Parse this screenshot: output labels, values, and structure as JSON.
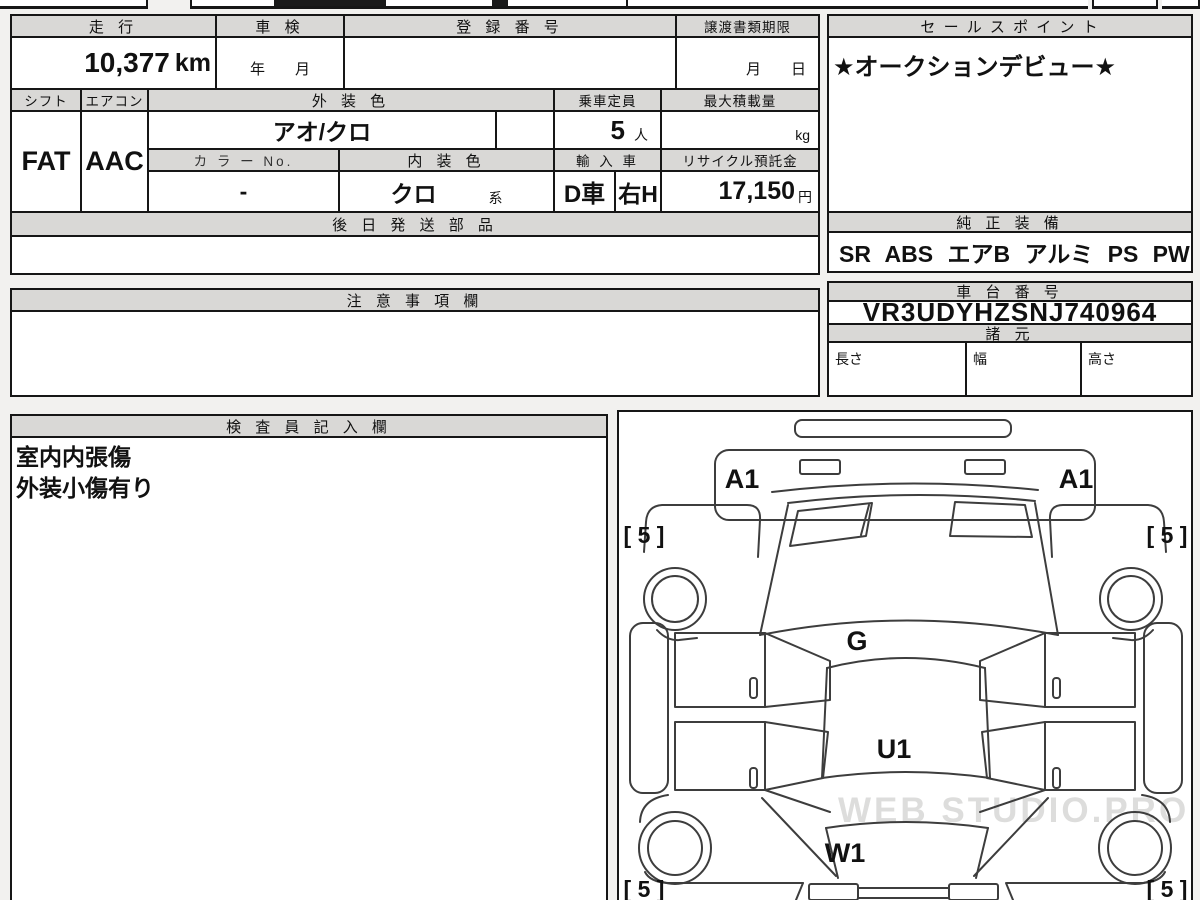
{
  "table": {
    "mileage_label": "走 行",
    "mileage_value": "10,377",
    "mileage_unit": "km",
    "shaken_label": "車 検",
    "shaken_value": "年　　月",
    "reg_label": "登 録 番 号",
    "reg_value": "",
    "transfer_label": "譲渡書類期限",
    "transfer_value": "月　　日",
    "shift_label": "シフト",
    "shift_value": "FAT",
    "aircon_label": "エアコン",
    "aircon_value": "AAC",
    "ext_color_label": "外 装 色",
    "ext_color_value": "アオ/クロ",
    "capacity_label": "乗車定員",
    "capacity_value": "5",
    "capacity_unit": "人",
    "max_load_label": "最大積載量",
    "max_load_unit": "kg",
    "color_no_label": "カ ラ ー No.",
    "color_no_value": "-",
    "int_color_label": "内 装 色",
    "int_color_value": "クロ",
    "int_color_suffix": "系",
    "import_label": "輸 入 車",
    "import_value_1": "D車",
    "import_value_2": "右H",
    "recycle_label": "リサイクル預託金",
    "recycle_value": "17,150",
    "recycle_unit": "円",
    "later_parts_label": "後 日 発 送 部 品",
    "later_parts_value": "",
    "notes_label": "注 意 事 項 欄",
    "notes_value": ""
  },
  "right_panel": {
    "sales_point_label": "セ ー ル ス ポ イ ン ト",
    "sales_point_value": "★オークションデビュー★",
    "equipment_label": "純 正 装 備",
    "equipment_value": "SR ABS エアB アルミ PS PW",
    "chassis_label": "車 台 番 号",
    "chassis_value": "VR3UDYHZSNJ740964",
    "specs_label": "諸 元",
    "spec_length_label": "長さ",
    "spec_width_label": "幅",
    "spec_height_label": "高さ",
    "spec_length_value": "",
    "spec_width_value": "",
    "spec_height_value": ""
  },
  "inspector": {
    "label": "検 査 員 記 入 欄",
    "line1": "室内内張傷",
    "line2": "外装小傷有り"
  },
  "diagram": {
    "a1_left": "A1",
    "a1_right": "A1",
    "tire_front_left": "[ 5 ]",
    "tire_front_right": "[ 5 ]",
    "tire_rear_left": "[ 5 ]",
    "tire_rear_right": "[ 5 ]",
    "hood_grade": "G",
    "roof_grade": "U1",
    "rear_grade": "W1",
    "watermark": "WEB STUDIO.PRO"
  }
}
